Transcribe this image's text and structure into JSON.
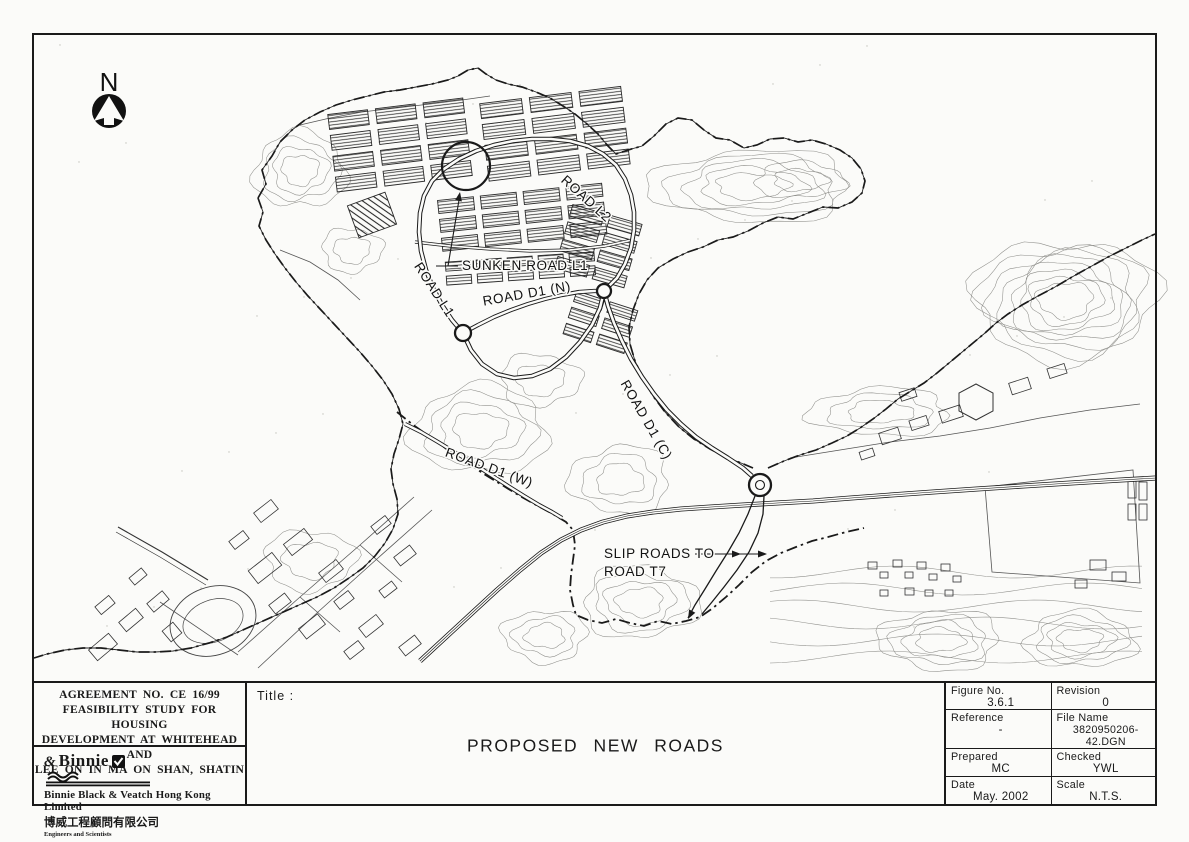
{
  "map": {
    "north_label": "N",
    "labels": {
      "sunken_road_l1": "SUNKEN ROAD L1",
      "road_l1": "ROAD L1",
      "road_l2": "ROAD L2",
      "road_d1_n": "ROAD D1 (N)",
      "road_d1_c": "ROAD D1 (C)",
      "road_d1_w": "ROAD D1 (W)",
      "slip_roads_line1": "SLIP ROADS TO",
      "slip_roads_line2": "ROAD T7"
    }
  },
  "title_block": {
    "agreement_lines": [
      "AGREEMENT NO. CE 16/99",
      "FEASIBILITY STUDY FOR HOUSING",
      "DEVELOPMENT AT WHITEHEAD AND",
      "LEE ON IN MA ON SHAN, SHATIN"
    ],
    "company": {
      "amp": "&",
      "logo_name": "Binnie",
      "name_en": "Binnie Black & Veatch Hong Kong Limited",
      "name_zh": "博威工程顧問有限公司",
      "tagline": "Engineers and Scientists"
    },
    "title_label": "Title :",
    "title": "PROPOSED NEW ROADS",
    "fields": [
      {
        "label": "Figure No.",
        "value": "3.6.1"
      },
      {
        "label": "Revision",
        "value": "0"
      },
      {
        "label": "Reference",
        "value": "-"
      },
      {
        "label": "File Name",
        "value": "3820950206-42.DGN"
      },
      {
        "label": "Prepared",
        "value": "MC"
      },
      {
        "label": "Checked",
        "value": "YWL"
      },
      {
        "label": "Date",
        "value": "May. 2002"
      },
      {
        "label": "Scale",
        "value": "N.T.S."
      }
    ]
  },
  "colors": {
    "ink": "#1a1a1a",
    "paper": "#fbfbf9",
    "contour": "#8f8f8b"
  }
}
